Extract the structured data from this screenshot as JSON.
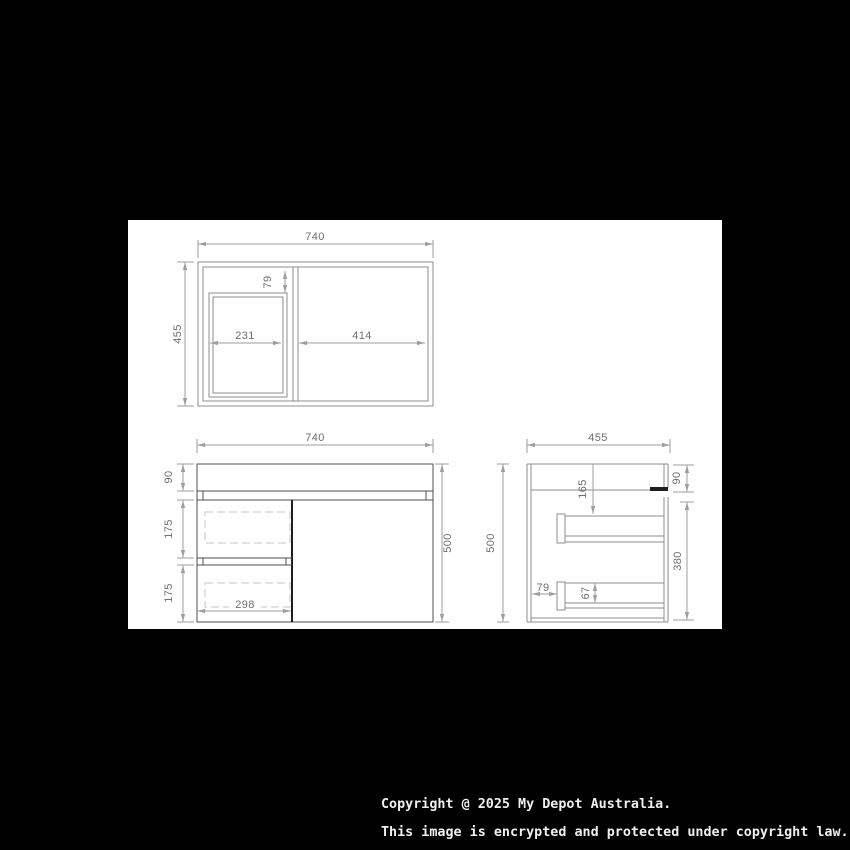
{
  "plan_view": {
    "width": "740",
    "depth": "455",
    "basin_inset": "79",
    "basin_width": "231",
    "right_section_width": "414"
  },
  "front_view": {
    "width": "740",
    "height": "500",
    "top_height": "90",
    "drawer1_height": "175",
    "drawer2_height": "175",
    "drawer_width": "298"
  },
  "side_view": {
    "depth": "455",
    "height": "500",
    "top_height": "90",
    "body_height": "380",
    "drawer_top_offset": "165",
    "drawer_inset": "79",
    "drawer_front_height": "67"
  },
  "footer": {
    "line1": "Copyright @ 2025 My Depot Australia.",
    "line2": "This image is encrypted and protected under copyright law."
  },
  "colors": {
    "background": "#000000",
    "panel": "#ffffff",
    "object_line": "#8c8c8c",
    "dimension_line": "#9e9e9e",
    "label_text": "#6e6e6e",
    "footer_text": "#f0f0f0"
  }
}
